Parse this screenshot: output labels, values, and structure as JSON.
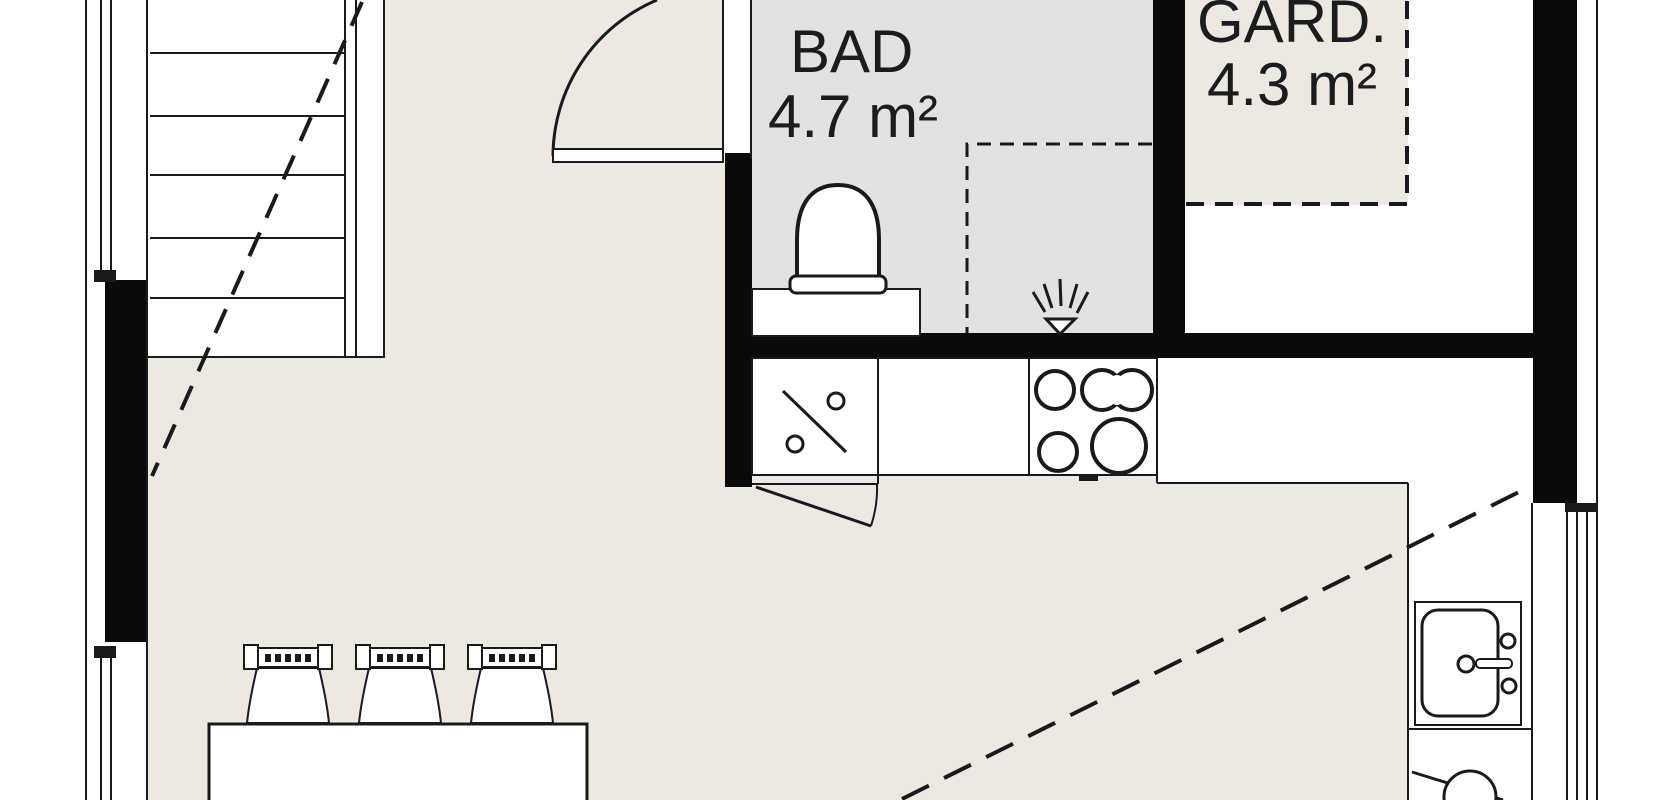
{
  "title": "apartment-floor-plan",
  "rooms": [
    {
      "id": "bad",
      "label": "BAD",
      "area": "4.7 m²"
    },
    {
      "id": "gard",
      "label": "GARD.",
      "area": "4.3 m²"
    }
  ],
  "colors": {
    "floor-beige": "#EBE9E2",
    "floor-gray": "#E2E2E2",
    "wall-black": "#0a0a0a",
    "line-dark": "#1a1a1a",
    "fixture-white": "#ffffff",
    "text-dark": "#1c1c1c"
  },
  "fixtures": [
    "staircase",
    "stair-direction-dashed-line",
    "entry-door-swing",
    "toilet",
    "shower-dashed-zone",
    "shower-head",
    "kitchen-dishwasher",
    "kitchen-cooktop",
    "kitchen-door-swing",
    "kitchen-sink",
    "washing-machine",
    "dining-table",
    "dining-chair",
    "window",
    "loft-edge-dashed-line"
  ]
}
